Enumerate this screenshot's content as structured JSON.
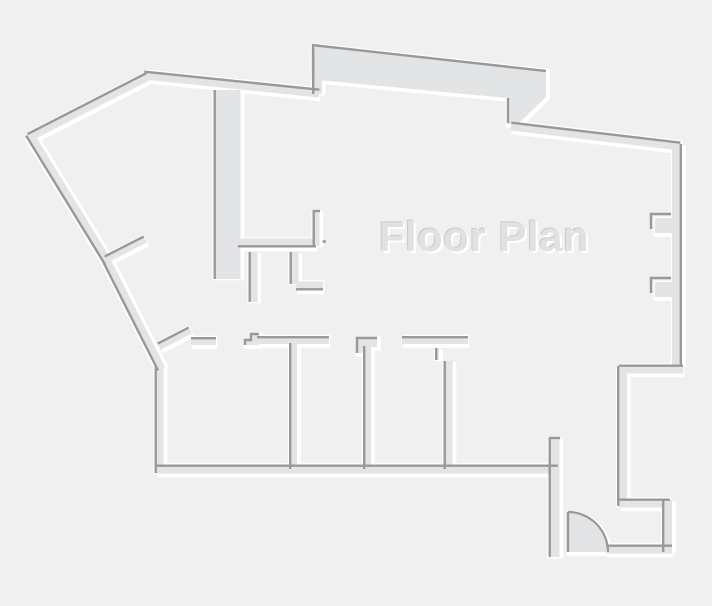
{
  "plan": {
    "title": "Floor Plan",
    "canvas": {
      "w": 712,
      "h": 606
    },
    "colors": {
      "bg": "#f0f0f1",
      "wall_fill": "#e2e4e5",
      "edge_dark": "#98999b",
      "highlight": "#ffffff",
      "title_fill": "#dfe1e2",
      "title_dark_edge": "#c9cbcd"
    },
    "title_pos": {
      "x": 484,
      "y": 251,
      "size": 42
    },
    "segments": [
      {
        "x1": 29,
        "y1": 137,
        "x2": 148,
        "y2": 76,
        "w": 9,
        "dark": "top"
      },
      {
        "x1": 144,
        "y1": 75,
        "x2": 319,
        "y2": 93,
        "w": 9,
        "dark": "top"
      },
      {
        "x1": 317,
        "y1": 49,
        "x2": 317,
        "y2": 94,
        "w": 10,
        "dark": "left"
      },
      {
        "x1": 511,
        "y1": 126,
        "x2": 680,
        "y2": 146,
        "w": 9,
        "dark": "top"
      },
      {
        "x1": 677,
        "y1": 144,
        "x2": 677,
        "y2": 366,
        "w": 10,
        "dark": "right"
      },
      {
        "x1": 683,
        "y1": 369,
        "x2": 619,
        "y2": 369,
        "w": 9,
        "dark": "top"
      },
      {
        "x1": 622,
        "y1": 366,
        "x2": 622,
        "y2": 506,
        "w": 10,
        "dark": "left"
      },
      {
        "x1": 619,
        "y1": 503,
        "x2": 670,
        "y2": 503,
        "w": 9,
        "dark": "top"
      },
      {
        "x1": 667,
        "y1": 500,
        "x2": 667,
        "y2": 552,
        "w": 10,
        "dark": "left"
      },
      {
        "x1": 672,
        "y1": 549,
        "x2": 606,
        "y2": 549,
        "w": 9,
        "dark": "top"
      },
      {
        "x1": 554,
        "y1": 438,
        "x2": 554,
        "y2": 557,
        "w": 11,
        "dark": "left"
      },
      {
        "x1": 156,
        "y1": 469,
        "x2": 558,
        "y2": 469,
        "w": 9,
        "dark": "top"
      },
      {
        "x1": 159,
        "y1": 365,
        "x2": 159,
        "y2": 473,
        "w": 9,
        "dark": "left"
      },
      {
        "x1": 105,
        "y1": 258,
        "x2": 161,
        "y2": 369,
        "w": 9,
        "dark": "left"
      },
      {
        "x1": 29,
        "y1": 134,
        "x2": 108,
        "y2": 263,
        "w": 9,
        "dark": "left"
      },
      {
        "x1": 227,
        "y1": 90,
        "x2": 227,
        "y2": 279,
        "w": 27,
        "dark": "left"
      },
      {
        "x1": 238,
        "y1": 243,
        "x2": 316,
        "y2": 243,
        "w": 9,
        "dark": "bottom"
      },
      {
        "x1": 316,
        "y1": 210,
        "x2": 316,
        "y2": 246,
        "w": 7,
        "dark": "left"
      },
      {
        "x1": 253,
        "y1": 252,
        "x2": 253,
        "y2": 302,
        "w": 9,
        "dark": "left"
      },
      {
        "x1": 294,
        "y1": 252,
        "x2": 294,
        "y2": 284,
        "w": 9,
        "dark": "left"
      },
      {
        "x1": 296,
        "y1": 286,
        "x2": 323,
        "y2": 286,
        "w": 9,
        "dark": "bottom"
      },
      {
        "x1": 159,
        "y1": 346,
        "x2": 190,
        "y2": 330,
        "w": 8,
        "dark": "top"
      },
      {
        "x1": 106,
        "y1": 259,
        "x2": 145,
        "y2": 239,
        "w": 8,
        "dark": "top"
      },
      {
        "x1": 191,
        "y1": 341,
        "x2": 216,
        "y2": 341,
        "w": 8,
        "dark": "top"
      },
      {
        "x1": 257,
        "y1": 340,
        "x2": 329,
        "y2": 340,
        "w": 8,
        "dark": "top"
      },
      {
        "x1": 293,
        "y1": 343,
        "x2": 293,
        "y2": 469,
        "w": 8,
        "dark": "left"
      },
      {
        "x1": 367,
        "y1": 346,
        "x2": 367,
        "y2": 469,
        "w": 8,
        "dark": "left"
      },
      {
        "x1": 402,
        "y1": 340,
        "x2": 468,
        "y2": 340,
        "w": 8,
        "dark": "top"
      },
      {
        "x1": 437,
        "y1": 348,
        "x2": 437,
        "y2": 360,
        "w": 4,
        "dark": "left"
      },
      {
        "x1": 448,
        "y1": 361,
        "x2": 448,
        "y2": 469,
        "w": 9,
        "dark": "left"
      }
    ],
    "polygons": [
      {
        "name": "top-band",
        "points": [
          [
            312,
            44
          ],
          [
            546,
            70
          ],
          [
            546,
            97
          ],
          [
            518,
            124
          ],
          [
            507,
            124
          ],
          [
            507,
            98
          ],
          [
            318,
            80
          ],
          [
            312,
            80
          ]
        ],
        "darks": [
          "M312,45 L546,71",
          "M313,44 L313,79",
          "M508,98 L508,123"
        ]
      },
      {
        "name": "door-jamb-step-1",
        "points": [
          [
            245,
            345
          ],
          [
            245,
            340
          ],
          [
            251,
            340
          ],
          [
            251,
            334
          ],
          [
            259,
            334
          ],
          [
            259,
            345
          ]
        ],
        "darks": [
          "M245,345 L245,340 L251,340 L251,334 L259,334"
        ]
      },
      {
        "name": "door-jamb-step-2",
        "points": [
          [
            357,
            353
          ],
          [
            357,
            338
          ],
          [
            377,
            338
          ],
          [
            377,
            347
          ],
          [
            364,
            347
          ],
          [
            364,
            353
          ]
        ],
        "darks": [
          "M357,353 L357,338 L377,338"
        ]
      },
      {
        "name": "right-wall-notch-upper",
        "points": [
          [
            655,
            218
          ],
          [
            679,
            218
          ],
          [
            679,
            233
          ],
          [
            655,
            233
          ]
        ],
        "darks": [
          "M651,229 L651,214 L671,214"
        ]
      },
      {
        "name": "right-wall-notch-lower",
        "points": [
          [
            655,
            282
          ],
          [
            679,
            282
          ],
          [
            679,
            297
          ],
          [
            655,
            297
          ]
        ],
        "darks": [
          "M651,293 L651,278 L671,278"
        ]
      }
    ],
    "extra_darks": [
      "M549,438 L560,438",
      "M312.5,211 L320,211",
      "M322.5,241.5 L326,241.5",
      "M568,512 L568,552"
    ],
    "door": {
      "fill_path": "M568,552 L568,512 A40,40 0 0 1 608,552 Z",
      "arc_dark": "M568,512 A40,40 0 0 1 608,552"
    }
  }
}
